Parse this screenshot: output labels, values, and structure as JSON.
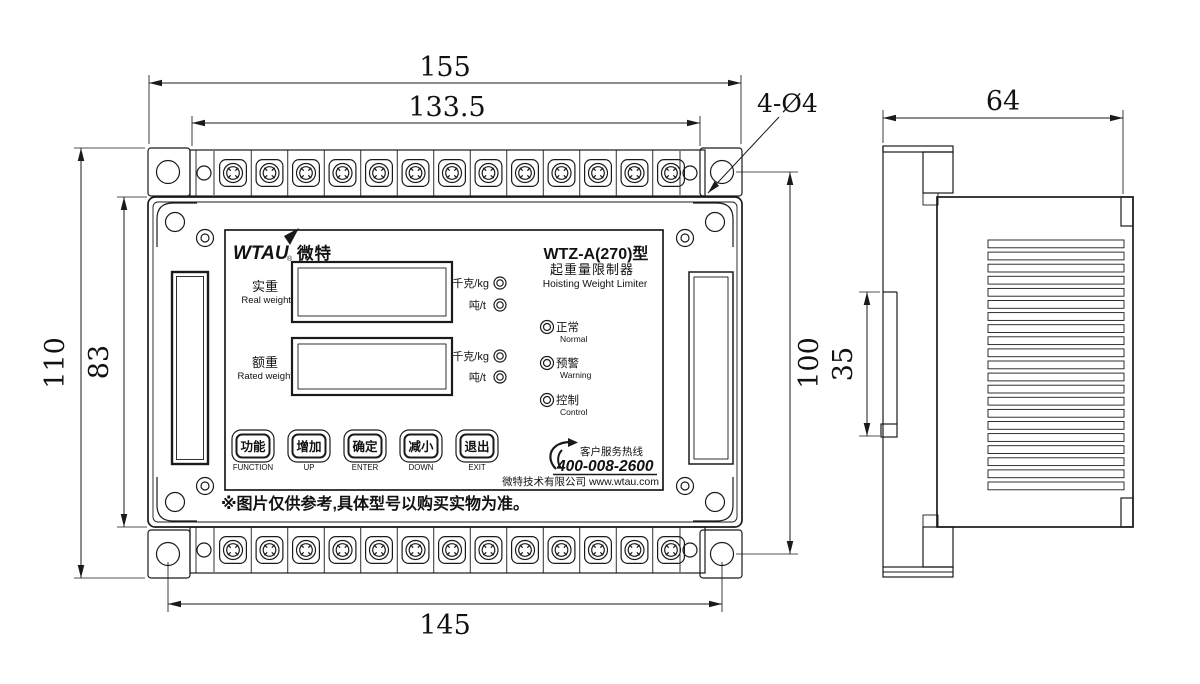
{
  "dims": {
    "overall_width": "155",
    "terminal_span_width": "133.5",
    "overall_height": "110",
    "body_height": "83",
    "mount_hole_span_vertical": "100",
    "mount_hole_span_horizontal": "145",
    "mount_hole_callout": "4-Ø4",
    "side_depth": "64",
    "din_rail_height": "35"
  },
  "panel": {
    "logo_en": "WTAU",
    "logo_reg": "®",
    "logo_cn": "微特",
    "model": "WTZ-A(270)型",
    "product_cn": "起重量限制器",
    "product_en": "Hoisting Weight Limiter",
    "real_weight_cn": "实重",
    "real_weight_en": "Real weight",
    "rated_weight_cn": "额重",
    "rated_weight_en": "Rated weight",
    "unit_kg": "千克/kg",
    "unit_t": "吨/t",
    "leds": [
      {
        "cn": "正常",
        "en": "Normal"
      },
      {
        "cn": "预警",
        "en": "Warning"
      },
      {
        "cn": "控制",
        "en": "Control"
      }
    ],
    "buttons": [
      {
        "cn": "功能",
        "en": "FUNCTION"
      },
      {
        "cn": "增加",
        "en": "UP"
      },
      {
        "cn": "确定",
        "en": "ENTER"
      },
      {
        "cn": "减小",
        "en": "DOWN"
      },
      {
        "cn": "退出",
        "en": "EXIT"
      }
    ],
    "hotline_label": "客户服务热线",
    "hotline_number": "400-008-2600",
    "company": "微特技术有限公司 www.wtau.com",
    "disclaimer": "※图片仅供参考,具体型号以购买实物为准。"
  },
  "figure": {
    "terminals_per_strip": 13,
    "vent_slats": 21,
    "line_color": "#1a1a1a",
    "background": "#ffffff"
  }
}
